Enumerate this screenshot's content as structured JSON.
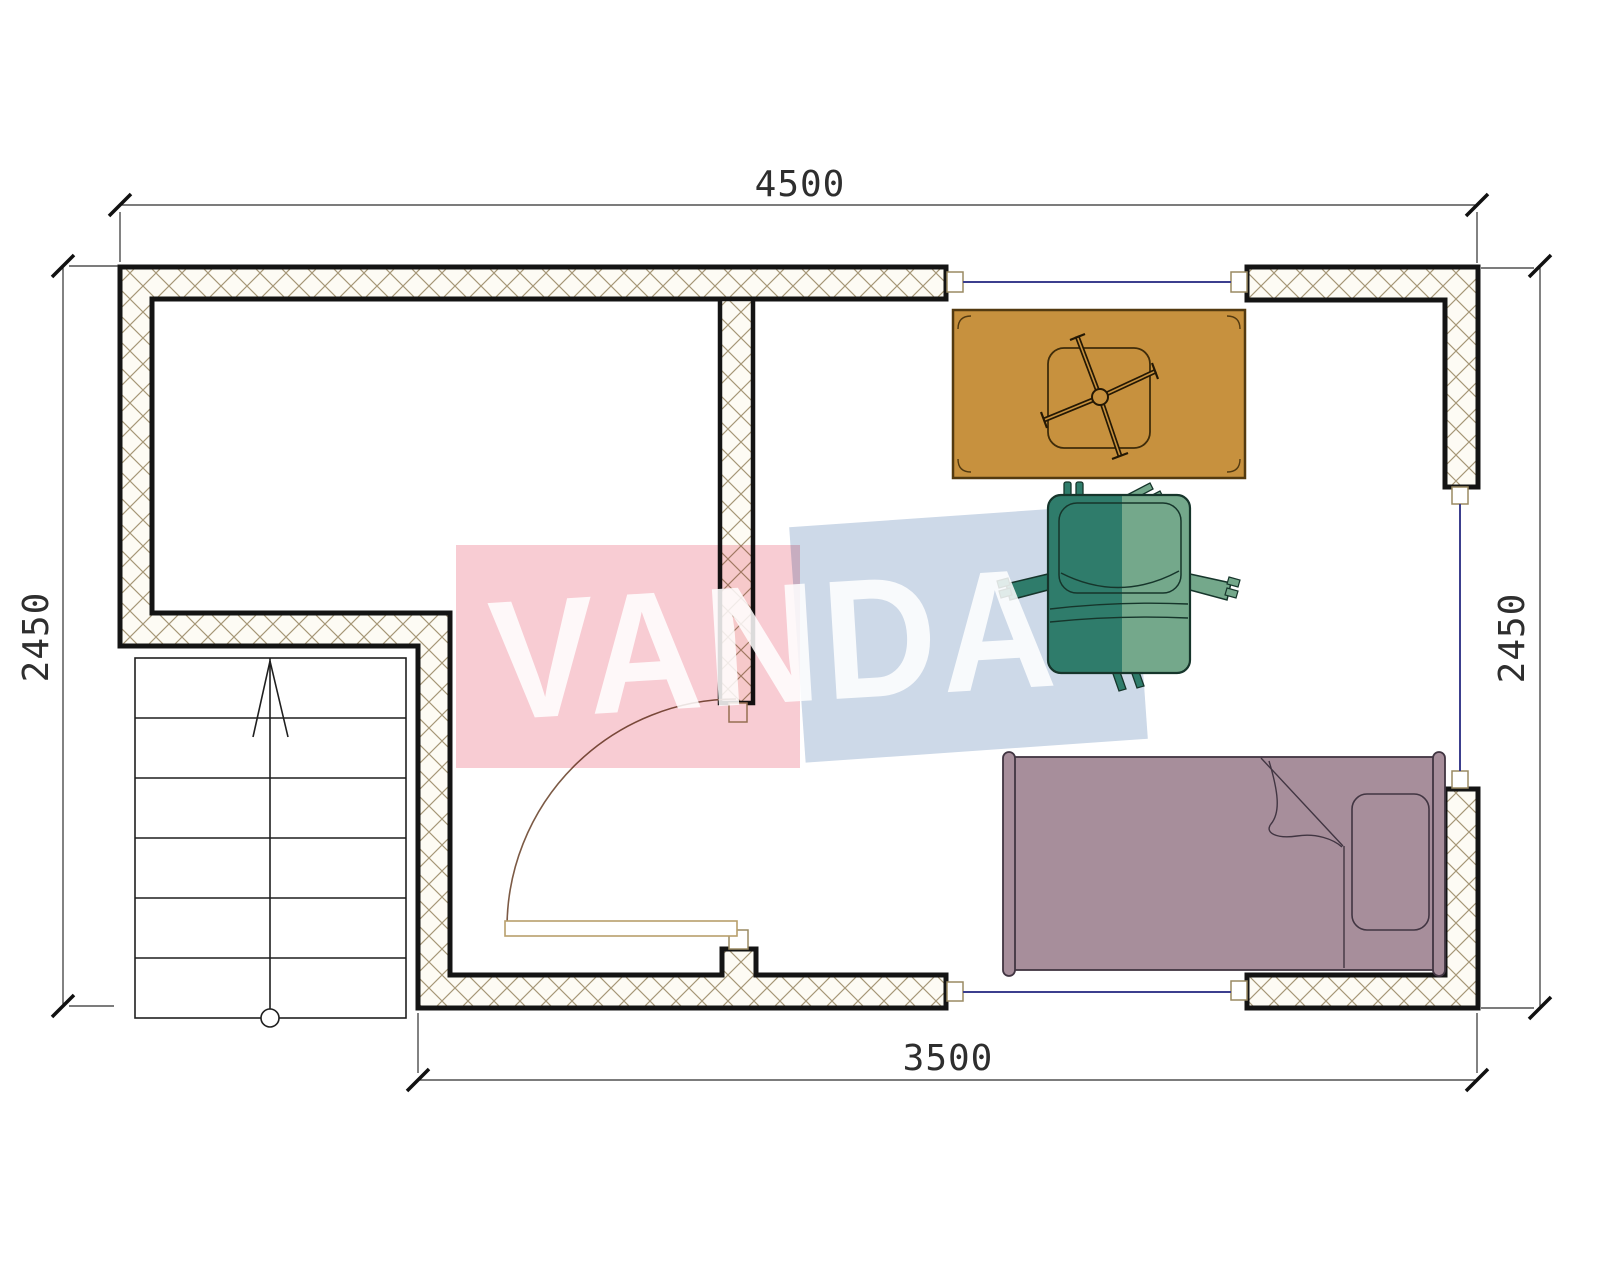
{
  "drawing": {
    "type": "architectural-floor-plan",
    "watermark": {
      "text": "VANDA",
      "pink_block_color": "#f8ccd3",
      "blue_block_color": "#cdd9e8",
      "text_color": "rgba(255,255,255,0.85)"
    },
    "dimensions": {
      "top": "4500",
      "bottom": "3500",
      "left": "2450",
      "right": "2450"
    },
    "plan": {
      "wall_border_color": "#141414",
      "wall_fill_color": "#fdfbf4",
      "hatch_line_color": "#a59676",
      "window_line_color": "#3c3f8e",
      "door_arc_color": "#7c5a45",
      "door_leaf_color": "#b89f6c",
      "stairs": {
        "treads": 6,
        "direction_arrow": "up"
      }
    },
    "furniture": {
      "table": {
        "label": "table",
        "fill": "#c7913e"
      },
      "armchair": {
        "label": "armchair",
        "fill_left": "#2f7c6b",
        "fill_right": "#74a88b"
      },
      "bed": {
        "label": "single-bed",
        "fill": "#a78e9b"
      }
    }
  }
}
